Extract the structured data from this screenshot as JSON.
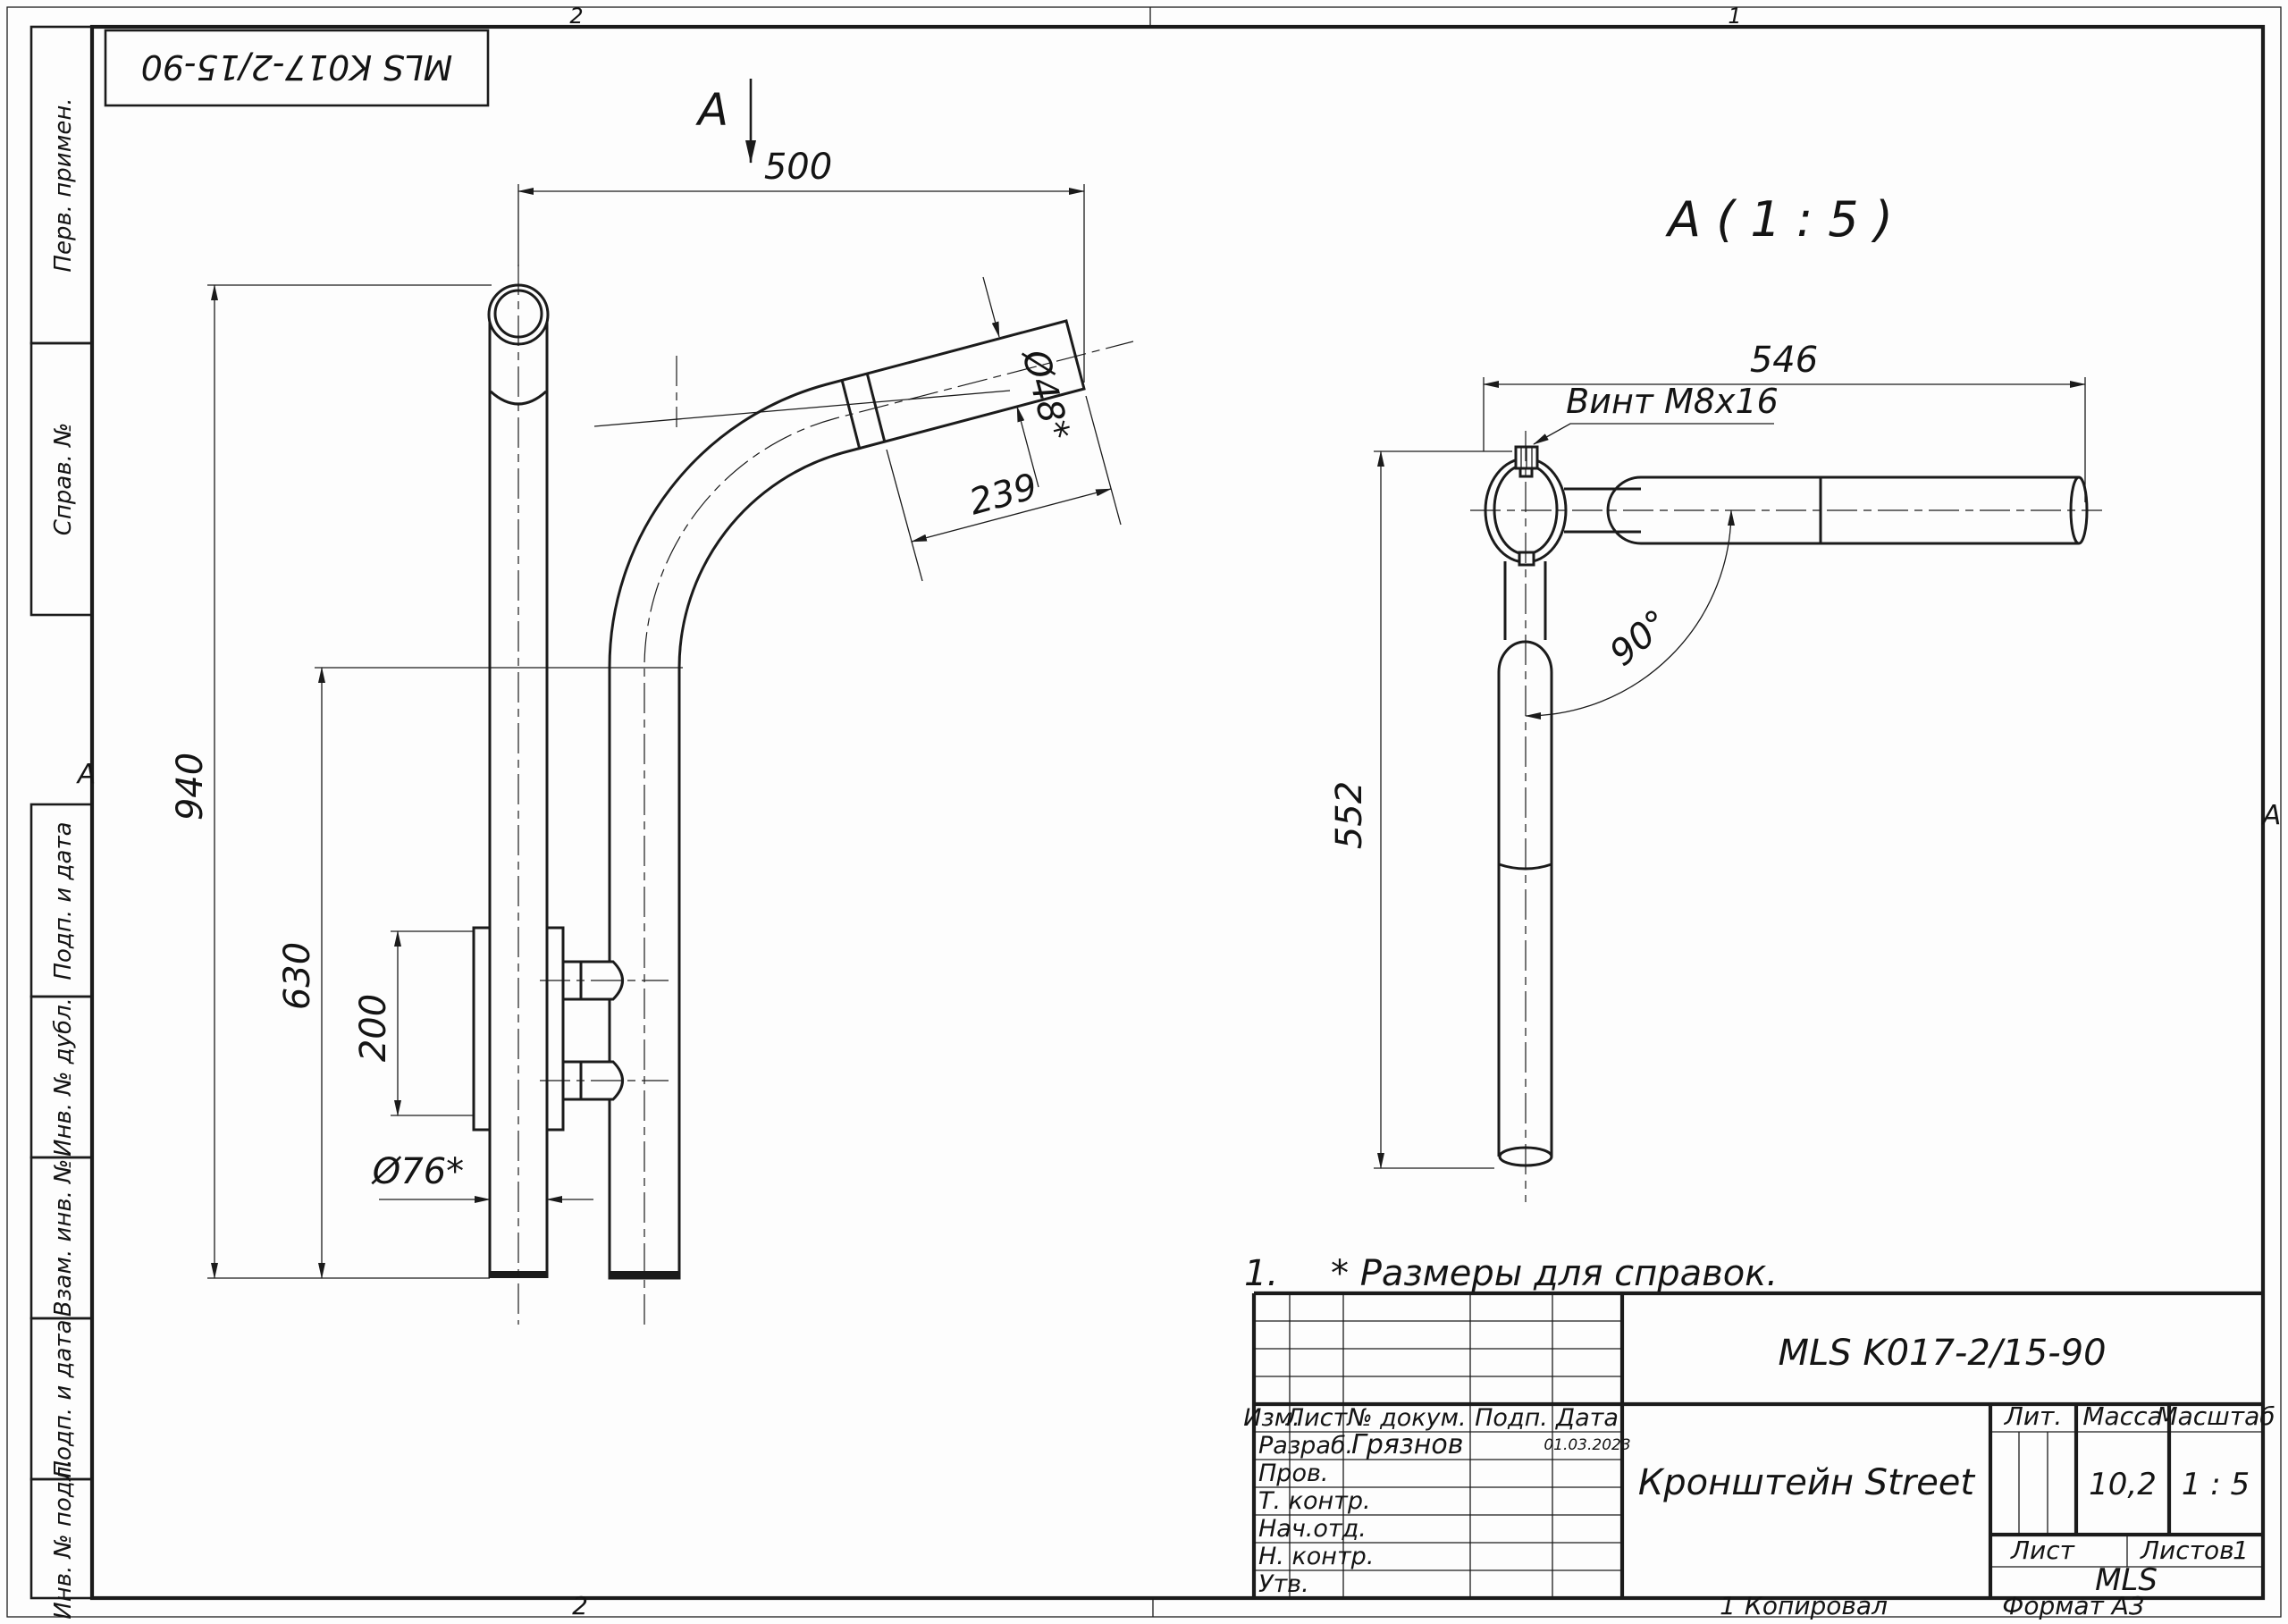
{
  "frame": {
    "zones": {
      "top_left": "2",
      "top_right": "1",
      "bottom_left": "2",
      "bottom_right": "1",
      "row_left": "A",
      "row_right": "А"
    },
    "footer": {
      "sheet_small": "1",
      "copied": "Копировал",
      "format": "Формат А3"
    }
  },
  "stamp": {
    "text": "MLS K017-2/15-90"
  },
  "sidebar": {
    "items": [
      {
        "label": "Перв. примен."
      },
      {
        "label": "Справ. №"
      },
      {
        "label": "Подп. и дата"
      },
      {
        "label": "Инв. № дубл."
      },
      {
        "label": "Взам. инв. №"
      },
      {
        "label": "Подп. и дата"
      },
      {
        "label": "Инв. № подл."
      }
    ]
  },
  "front_view": {
    "view_label": "A",
    "dim_width": "500",
    "dim_height": "940",
    "dim_height_inner": "630",
    "dim_plate": "200",
    "dim_post_dia": "Ø76*",
    "dim_arm_len": "239",
    "dim_arm_dia": "Ø48*"
  },
  "detail_view": {
    "title": "A ( 1 : 5 )",
    "screw_label": "Винт М8х16",
    "dim_width": "546",
    "dim_height": "552",
    "dim_angle": "90°"
  },
  "note": {
    "number": "1.",
    "text": "* Размеры для справок."
  },
  "title_block": {
    "designation": "MLS K017-2/15-90",
    "name": "Кронштейн Street",
    "company": "MLS",
    "change_header": [
      "Изм.",
      "Лист",
      "№ докум.",
      "Подп.",
      "Дата"
    ],
    "signature_rows": [
      {
        "role": "Разраб.",
        "name": "Грязнов",
        "date": "01.03.2023"
      },
      {
        "role": "Пров.",
        "name": "",
        "date": ""
      },
      {
        "role": "Т. контр.",
        "name": "",
        "date": ""
      },
      {
        "role": "Нач.отд.",
        "name": "",
        "date": ""
      },
      {
        "role": "Н. контр.",
        "name": "",
        "date": ""
      },
      {
        "role": "Утв.",
        "name": "",
        "date": ""
      }
    ],
    "lit_label": "Лит.",
    "mass_label": "Масса",
    "mass_value": "10,2",
    "scale_label": "Масштаб",
    "scale_value": "1 : 5",
    "sheet_label": "Лист",
    "sheets_label": "Листов",
    "sheets_value": "1"
  }
}
